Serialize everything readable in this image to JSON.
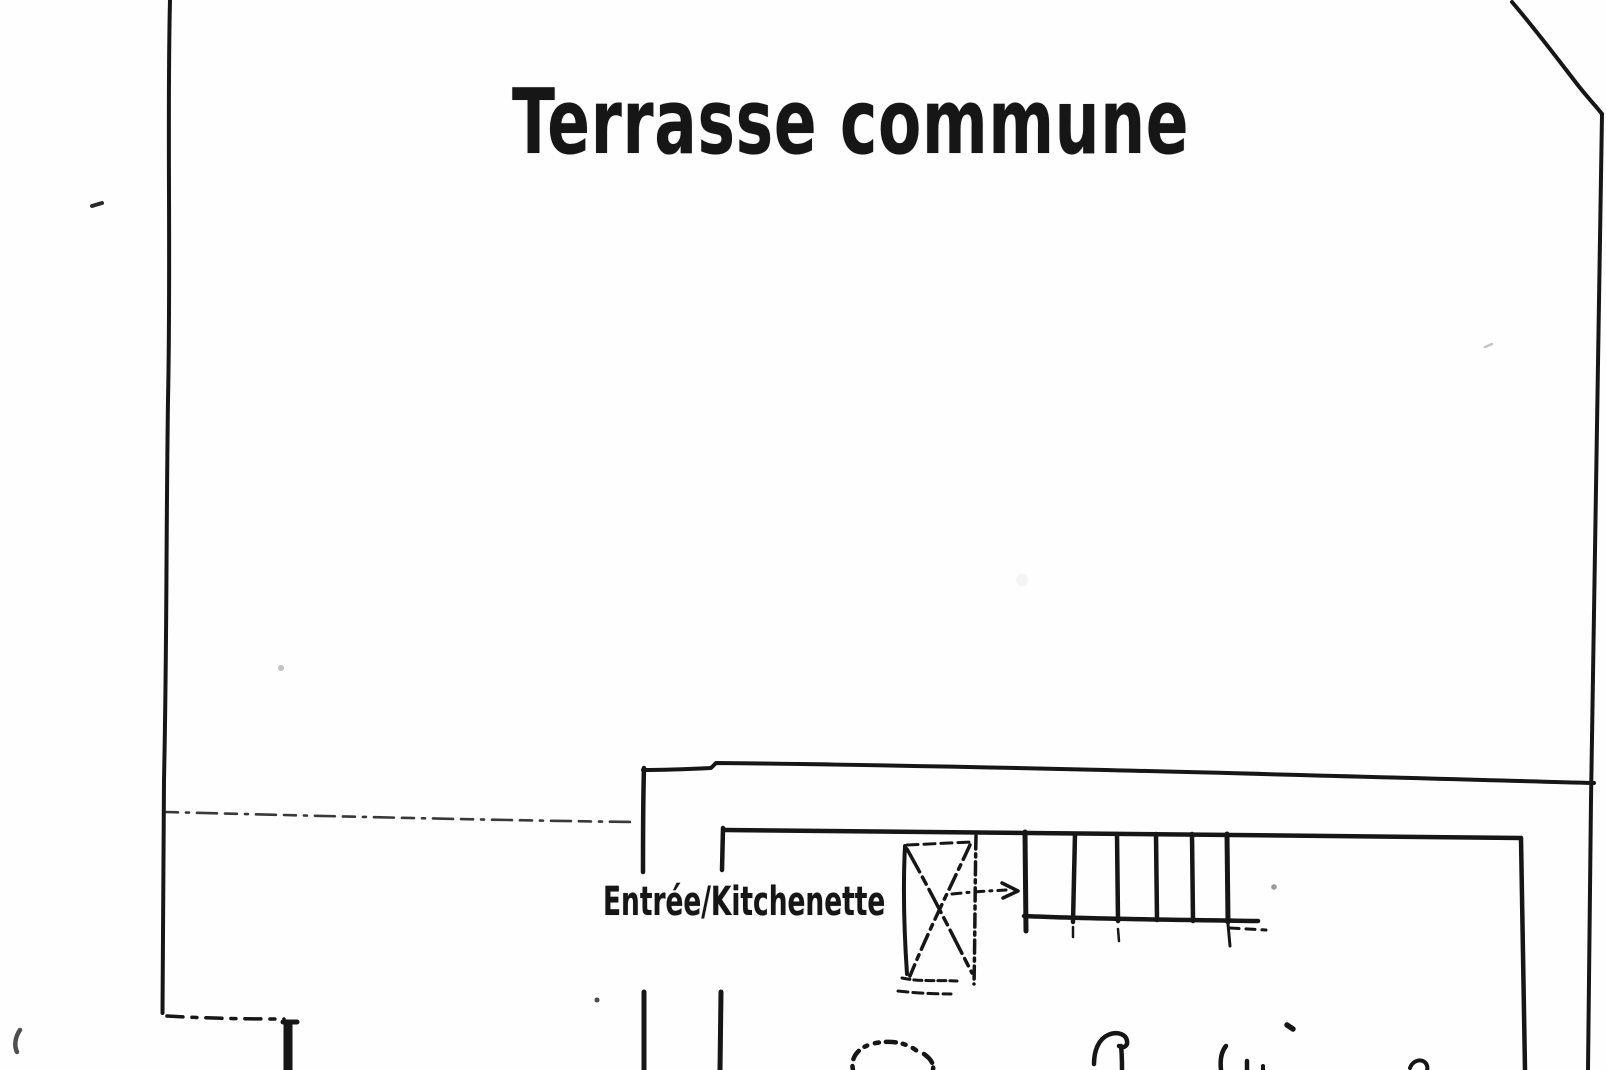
{
  "floor_plan": {
    "labels": {
      "terrace": "Terrasse commune",
      "entrance": "Entrée/Kitchenette"
    },
    "handwriting": "illegible handwritten cursive word, cut off at bottom edge",
    "colors": {
      "ink": "#161616",
      "paper": "#fefefe"
    }
  }
}
